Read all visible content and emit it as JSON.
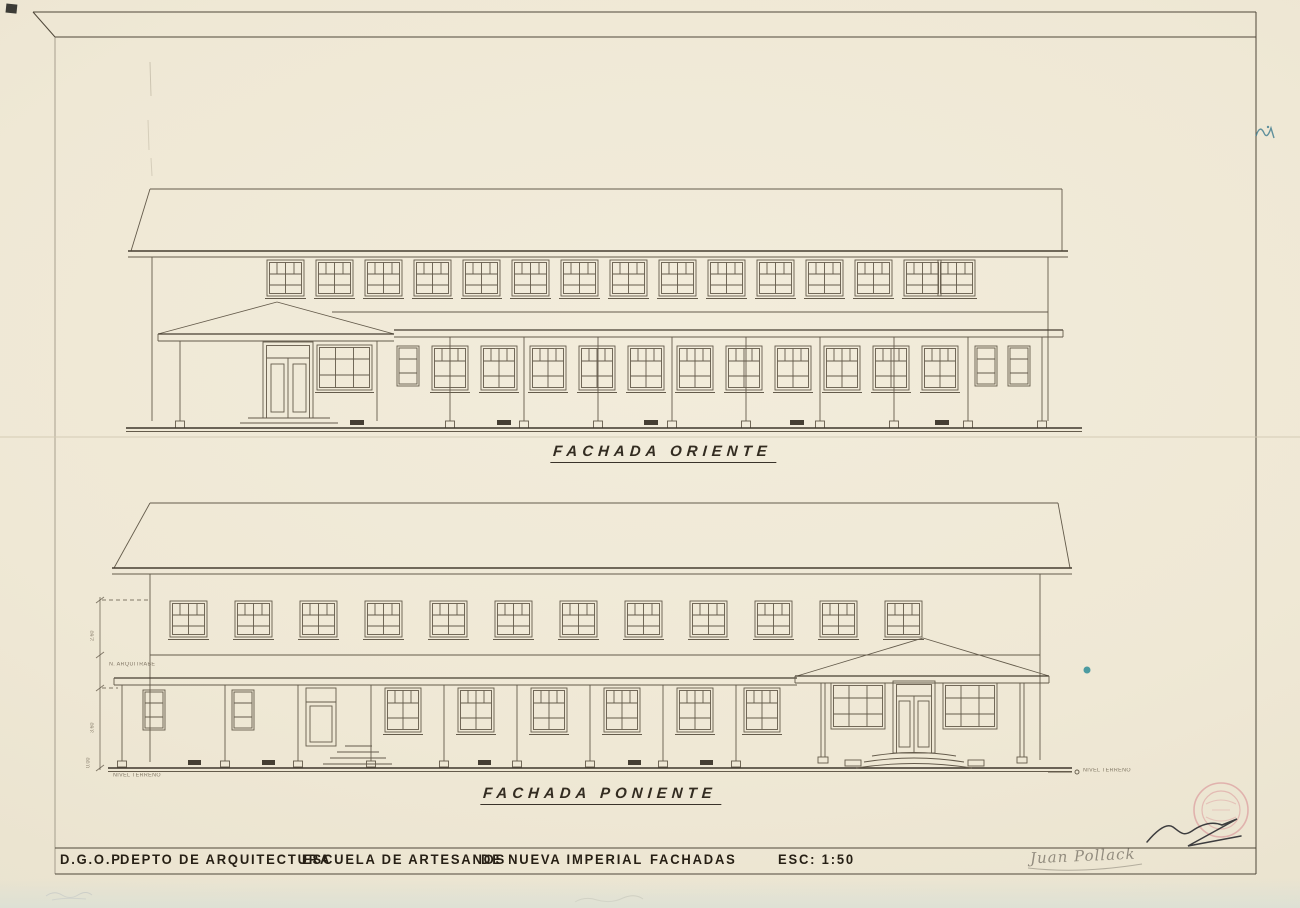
{
  "sheet": {
    "kind": "architectural elevation drawing, scanned blueprint",
    "paper_color": "#efe8d5",
    "ink_color": "#5a5144",
    "stamp_color": "#d98f94",
    "blue_mark_color": "#3d7b8f"
  },
  "elevations": [
    {
      "id": "oriente",
      "title": "FACHADA ORIENTE"
    },
    {
      "id": "poniente",
      "title": "FACHADA PONIENTE"
    }
  ],
  "title_block": {
    "org": "D.G.O.P.",
    "department": "DEPTO DE ARQUITECTURA",
    "project": "ESCUELA DE ARTESANOS",
    "location": "DE NUEVA IMPERIAL",
    "drawing": "FACHADAS",
    "scale": "ESC: 1:50"
  },
  "annotations": {
    "architrave_level": "N. ARQUITRABE",
    "ground_level_left": "NIVEL TERRENO",
    "ground_level_right": "NIVEL TERRENO",
    "dim_upper": "2.60",
    "dim_lower": "3.60",
    "dim_zero": "0.00"
  },
  "signatures": {
    "engineer": "Juan Pollack"
  }
}
